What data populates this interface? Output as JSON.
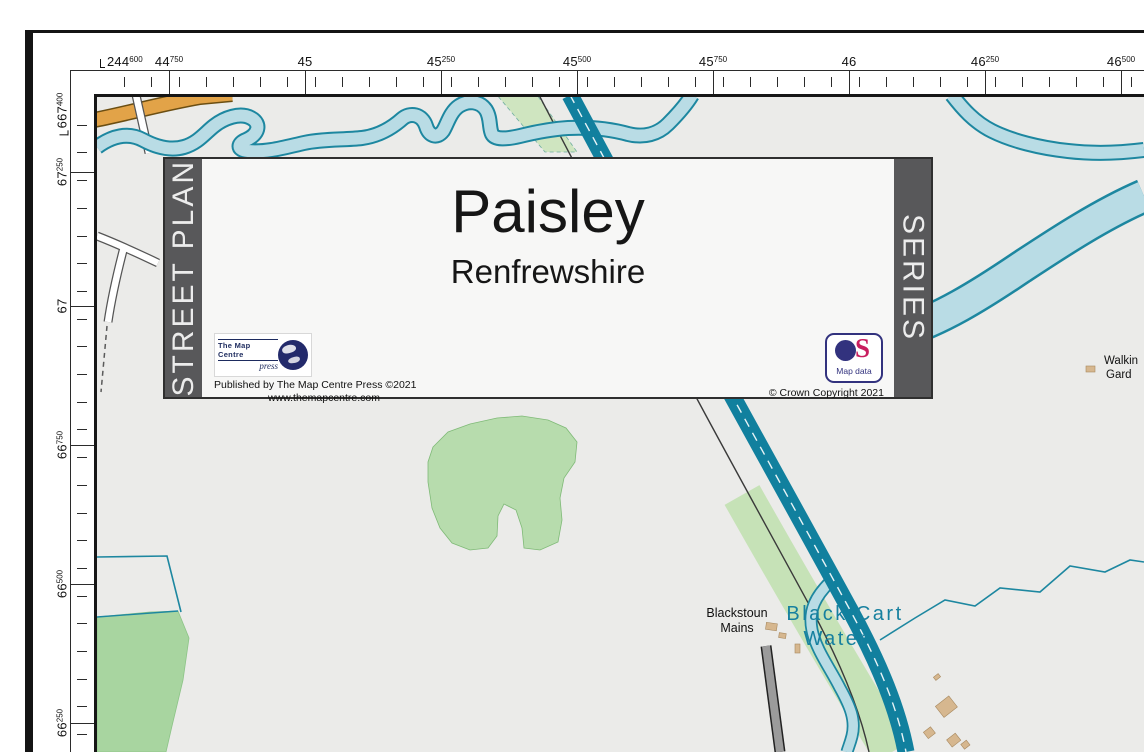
{
  "rulers": {
    "top": {
      "corner_label": {
        "main": "244",
        "sup": "600",
        "x": 100
      },
      "labels": [
        {
          "main": "44",
          "sup": "750",
          "x": 169
        },
        {
          "main": "45",
          "sup": "",
          "x": 305
        },
        {
          "main": "45",
          "sup": "250",
          "x": 441
        },
        {
          "main": "45",
          "sup": "500",
          "x": 577
        },
        {
          "main": "45",
          "sup": "750",
          "x": 713
        },
        {
          "main": "46",
          "sup": "",
          "x": 849
        },
        {
          "main": "46",
          "sup": "250",
          "x": 985
        },
        {
          "main": "46",
          "sup": "500",
          "x": 1121
        }
      ]
    },
    "left": {
      "corner_label": {
        "main": "667",
        "sup": "400",
        "y": 114
      },
      "labels": [
        {
          "main": "67",
          "sup": "250",
          "y": 172
        },
        {
          "main": "67",
          "sup": "",
          "y": 306
        },
        {
          "main": "66",
          "sup": "750",
          "y": 445
        },
        {
          "main": "66",
          "sup": "500",
          "y": 584
        },
        {
          "main": "66",
          "sup": "250",
          "y": 723
        }
      ]
    }
  },
  "title_box": {
    "side_left": "STREET PLAN",
    "side_right": "SERIES",
    "title": "Paisley",
    "subtitle": "Renfrewshire",
    "publisher_logo": {
      "name": "The Map Centre",
      "sub": "press"
    },
    "published_line": "Published by The Map Centre Press ©2021",
    "website": "www.themapcentre.com",
    "os_logo": {
      "s": "S",
      "caption": "Map data"
    },
    "copyright": "© Crown Copyright 2021"
  },
  "map_labels": {
    "farm": {
      "line1": "Blackstoun",
      "line2": "Mains"
    },
    "river": {
      "line1": "Black Cart",
      "line2": "Water"
    },
    "edge_truncated": {
      "line1": "Walkin",
      "line2": "Gard"
    }
  },
  "colors": {
    "map_background": "#ebebe9",
    "river_fill": "#b9dce5",
    "river_stroke": "#1d87a0",
    "canal": "#11809e",
    "woodland": "#b7dcad",
    "field_green": "#a8d5a0",
    "canal_buffer": "#c6e2b7",
    "road_orange": "#e2a348",
    "road_gray": "#9b9b9b",
    "building_tan": "#d6b78f",
    "band_gray": "#58585a",
    "os_navy": "#32327e",
    "os_magenta": "#c81e5f",
    "river_label": "#17809f"
  }
}
